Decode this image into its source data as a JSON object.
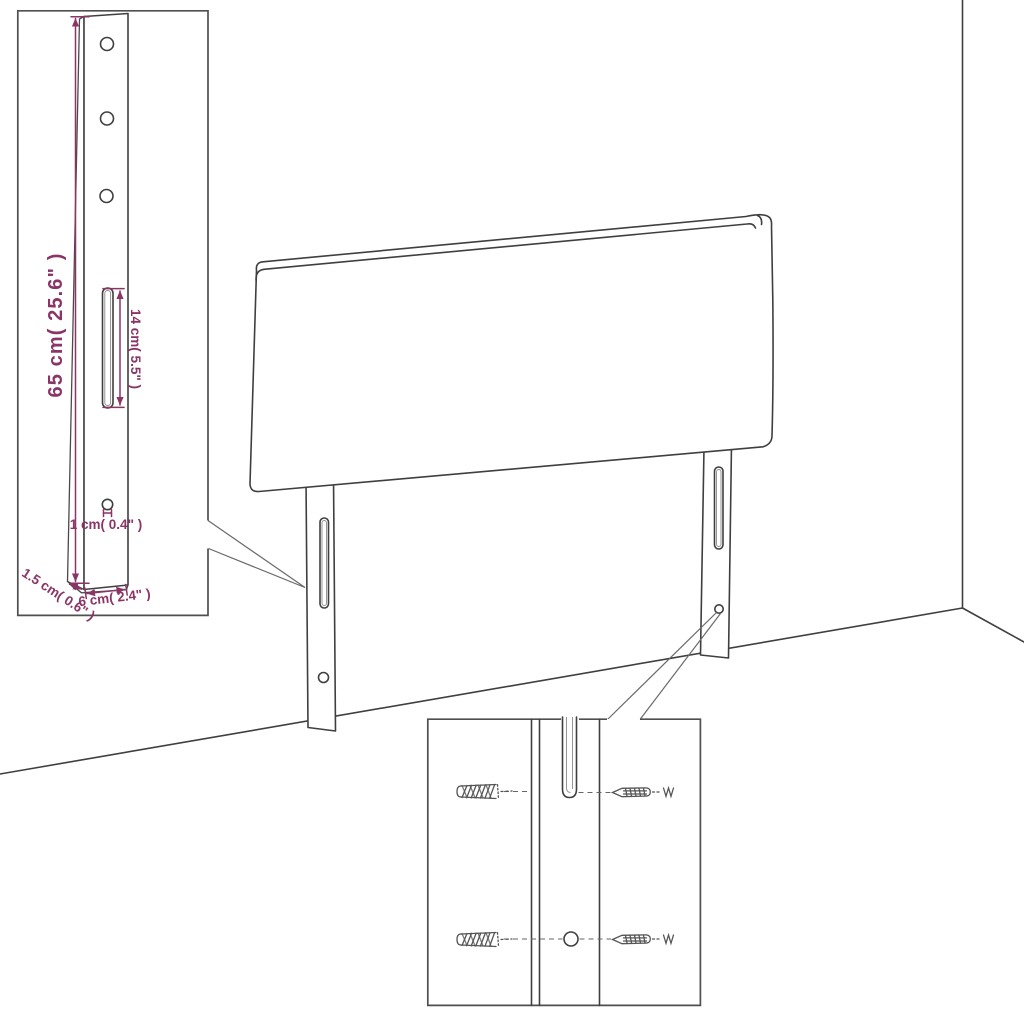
{
  "page": {
    "background": "#ffffff",
    "description": "Headboard assembly dimension diagram with leg detail inset and wall-mounting hardware inset"
  },
  "colors": {
    "line": "#3f3f3f",
    "dimension": "#8a3566",
    "inset_border": "#4f4f4f"
  },
  "main_drawing": {
    "parts": [
      "headboard-panel",
      "left-leg",
      "right-leg",
      "wall-corner",
      "floor"
    ]
  },
  "insets": {
    "leg_detail": {
      "dimensions": {
        "height": "65 cm( 25.6\" )",
        "slot_length": "14 cm( 5.5\" )",
        "hole": "1 cm( 0.4\" )",
        "thickness": "1.5 cm( 0.6\" )",
        "width": "6 cm( 2.4\" )"
      }
    },
    "mounting_detail": {
      "hardware": [
        "wall-anchor",
        "screw",
        "wall-anchor",
        "screw"
      ]
    }
  }
}
